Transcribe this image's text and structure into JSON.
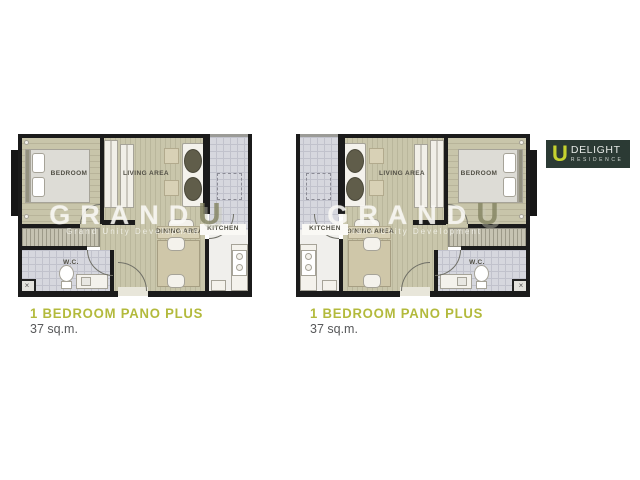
{
  "logo": {
    "letter": "U",
    "brand": "DELIGHT",
    "sub_brand": "RESIDENCE",
    "bg_color": "#2b3a34",
    "letter_color": "#c5d22f",
    "text_color": "#e5e8e5"
  },
  "watermark": {
    "brand": "GRAND",
    "brand_accent": "U",
    "tagline": "Grand Unity Development"
  },
  "plans": [
    {
      "id": "left-unit",
      "mirrored": false,
      "title": "1 BEDROOM PANO PLUS",
      "area": "37 sq.m.",
      "rooms": {
        "bedroom": "BEDROOM",
        "living_area": "LIVING AREA",
        "dining_area": "DINING AREA",
        "kitchen": "KITCHEN",
        "wc": "W.C."
      }
    },
    {
      "id": "right-unit",
      "mirrored": true,
      "title": "1 BEDROOM PANO PLUS",
      "area": "37 sq.m.",
      "rooms": {
        "bedroom": "BEDROOM",
        "living_area": "LIVING AREA",
        "dining_area": "DINING AREA",
        "kitchen": "KITCHEN",
        "wc": "W.C."
      }
    }
  ],
  "shaft_mark": "×",
  "colors": {
    "title_accent": "#b3ba3c",
    "area_text": "#57585a",
    "wall": "#1b1b1b",
    "floor_wood": "#c9c6ab",
    "floor_tile": "#d6d7de",
    "sofa_cushion": "#605d4a"
  }
}
